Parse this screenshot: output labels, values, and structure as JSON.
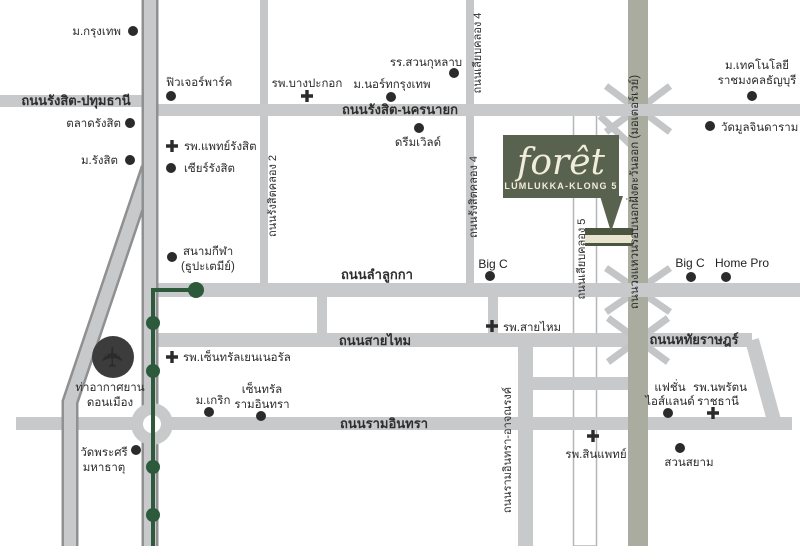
{
  "project": {
    "name": "forêt",
    "subtitle": "LUMLUKKA-KLONG 5"
  },
  "icons": {
    "airplane": "✈"
  },
  "colors": {
    "road_gray": "#c8c9cb",
    "road_casing": "#8f9092",
    "motorway_olive": "#a9ac9f",
    "brand_green": "#59624f",
    "marker_dark_green": "#4a5540",
    "marker_cream": "#e7e3cf",
    "transit_green": "#2d5a3a",
    "poi_dark": "#2b2b2b"
  },
  "roads": {
    "rangsit_pathumthani": "ถนนรังสิต-ปทุมธานี",
    "rangsit_nakhonnayok": "ถนนรังสิต-นครนายก",
    "liab_klong4": "ถนนเลียบคลอง 4",
    "rangsit_klong2": "ถนนรังสิตคลอง 2",
    "rangsit_klong4": "ถนนรังสิตคลอง 4",
    "liab_klong5": "ถนนเลียบคลอง 5",
    "lamlukka": "ถนนลำลูกกา",
    "saimai": "ถนนสายไหม",
    "ramindra": "ถนนรามอินทรา",
    "hathairat": "ถนนหทัยราษฎร์",
    "outer_ring_motorway": "ถนนวงแหวนรอบนอกฝั่งตะวันออก (มอเตอร์เวย์)",
    "ramindra_atnarong": "ถนนรามอินทรา-อาจณรงค์"
  },
  "places": {
    "bangkok_univ": "ม.กรุงเทพ",
    "future_park": "ฟิวเจอร์พาร์ค",
    "rangsit_market": "ตลาดรังสิต",
    "rangsit_univ": "ม.รังสิต",
    "paet_rangsit_hospital": "รพ.แพทย์รังสิต",
    "zeer_rangsit": "เซียร์รังสิต",
    "bangpakok_hospital": "รพ.บางปะกอก",
    "north_bangkok_univ": "ม.นอร์ทกรุงเทพ",
    "suankularb_school": "รร.สวนกุหลาบ",
    "dream_world": "ดรีมเวิลด์",
    "rmutt_line1": "ม.เทคโนโลยี",
    "rmutt_line2": "ราชมงคลธัญบุรี",
    "wat_muljindaram": "วัดมูลจินดาราม",
    "big_c_klong5": "Big C",
    "big_c_east": "Big C",
    "home_pro": "Home Pro",
    "stadium_line1": "สนามกีฬา",
    "stadium_line2": "(ธูปะเตมีย์)",
    "central_general_hospital": "รพ.เซ็นทรัลเยนเนอรัล",
    "don_mueang_line1": "ท่าอากาศยาน",
    "don_mueang_line2": "ดอนเมือง",
    "wat_phrasri_line1": "วัดพระศรี",
    "wat_phrasri_line2": "มหาธาตุ",
    "krirk_univ": "ม.เกริก",
    "central_ramindra_line1": "เซ็นทรัล",
    "central_ramindra_line2": "รามอินทรา",
    "saimai_hospital": "รพ.สายไหม",
    "fashion_island_line1": "แฟชั่น",
    "fashion_island_line2": "ไอส์แลนด์",
    "nopparat_line1": "รพ.นพรัตน",
    "nopparat_line2": "ราชธานี",
    "sinphaet_hospital": "รพ.สินแพทย์",
    "siam_park": "สวนสยาม"
  }
}
